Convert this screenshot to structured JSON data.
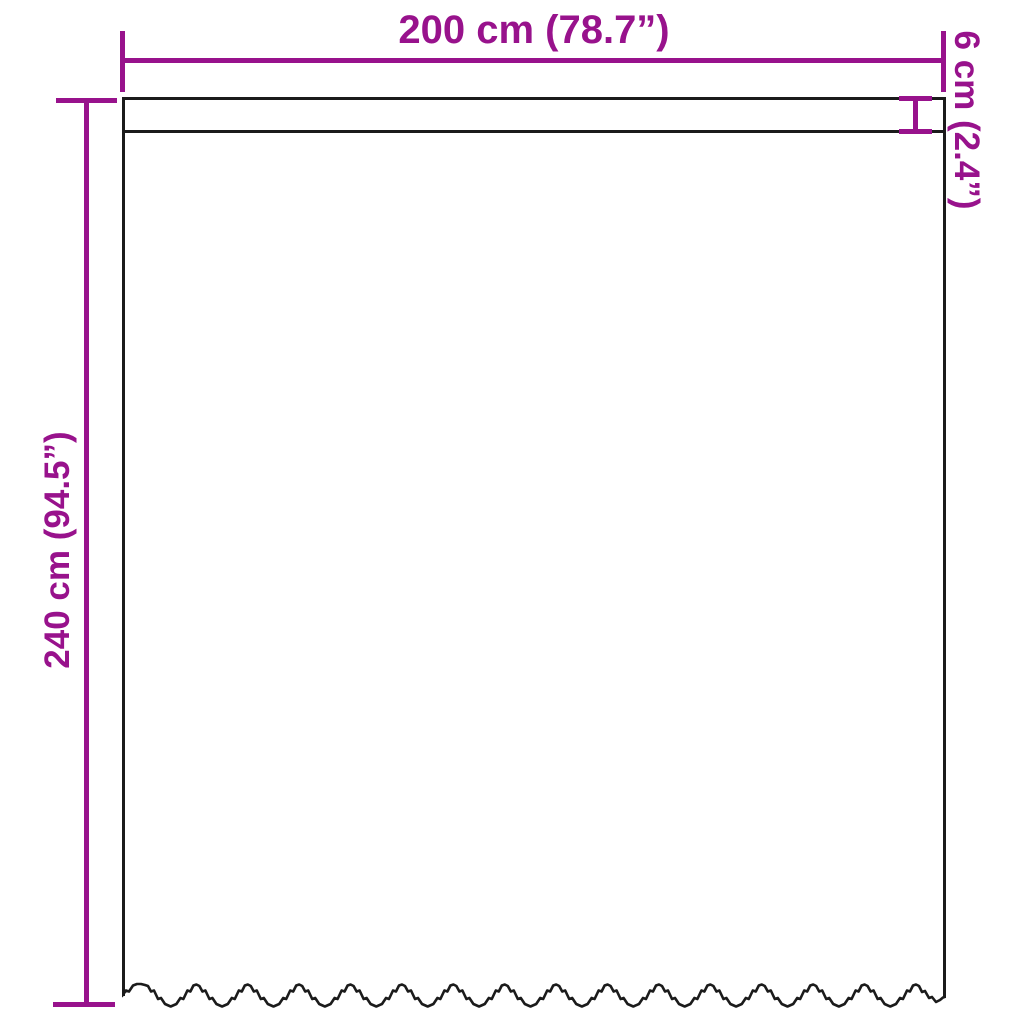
{
  "diagram": {
    "dimensions": {
      "width": {
        "cm": 200,
        "inches": 78.7,
        "label": "200 cm (78.7”)"
      },
      "height": {
        "cm": 240,
        "inches": 94.5,
        "label": "240 cm (94.5”)"
      },
      "header_height": {
        "cm": 6,
        "inches": 2.4,
        "label": "6 cm (2.4”)"
      }
    }
  },
  "colors": {
    "dimension_accent": "#98128c",
    "outline": "#1b1b1b",
    "background": "#ffffff"
  }
}
